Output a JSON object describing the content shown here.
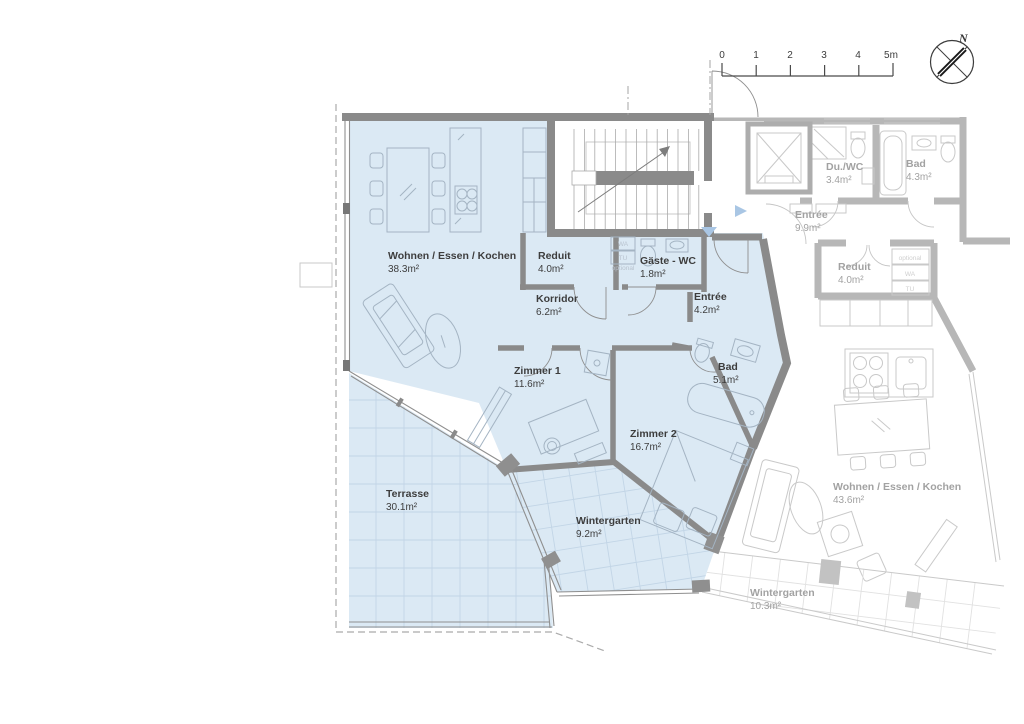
{
  "plan_type": "floor-plan",
  "scale_bar": {
    "ticks": [
      "0",
      "1",
      "2",
      "3",
      "4",
      "5m"
    ]
  },
  "compass": {
    "label": "N"
  },
  "colors": {
    "highlight_fill": "#dbe9f4",
    "wall_dark": "#8a8a8a",
    "wall_faded": "#b7b7b7",
    "entry_marker": "#a9c6e4"
  },
  "apartment": {
    "rooms": [
      {
        "name": "Wohnen / Essen / Kochen",
        "area": "38.3m²"
      },
      {
        "name": "Reduit",
        "area": "4.0m²"
      },
      {
        "name": "Gäste - WC",
        "area": "1.8m²"
      },
      {
        "name": "Korridor",
        "area": "6.2m²"
      },
      {
        "name": "Entrée",
        "area": "4.2m²"
      },
      {
        "name": "Zimmer 1",
        "area": "11.6m²"
      },
      {
        "name": "Zimmer 2",
        "area": "16.7m²"
      },
      {
        "name": "Bad",
        "area": "5.1m²"
      },
      {
        "name": "Terrasse",
        "area": "30.1m²"
      },
      {
        "name": "Wintergarten",
        "area": "9.2m²"
      }
    ]
  },
  "neighbor": {
    "rooms": [
      {
        "name": "Du./WC",
        "area": "3.4m²"
      },
      {
        "name": "Bad",
        "area": "4.3m²"
      },
      {
        "name": "Entrée",
        "area": "9.9m²"
      },
      {
        "name": "Reduit",
        "area": "4.0m²"
      },
      {
        "name": "Wohnen / Essen / Kochen",
        "area": "43.6m²"
      },
      {
        "name": "Wintergarten",
        "area": "10.3m²"
      }
    ]
  },
  "appliance_box": {
    "optional": "optional",
    "washer": "WA",
    "dryer": "TU"
  }
}
